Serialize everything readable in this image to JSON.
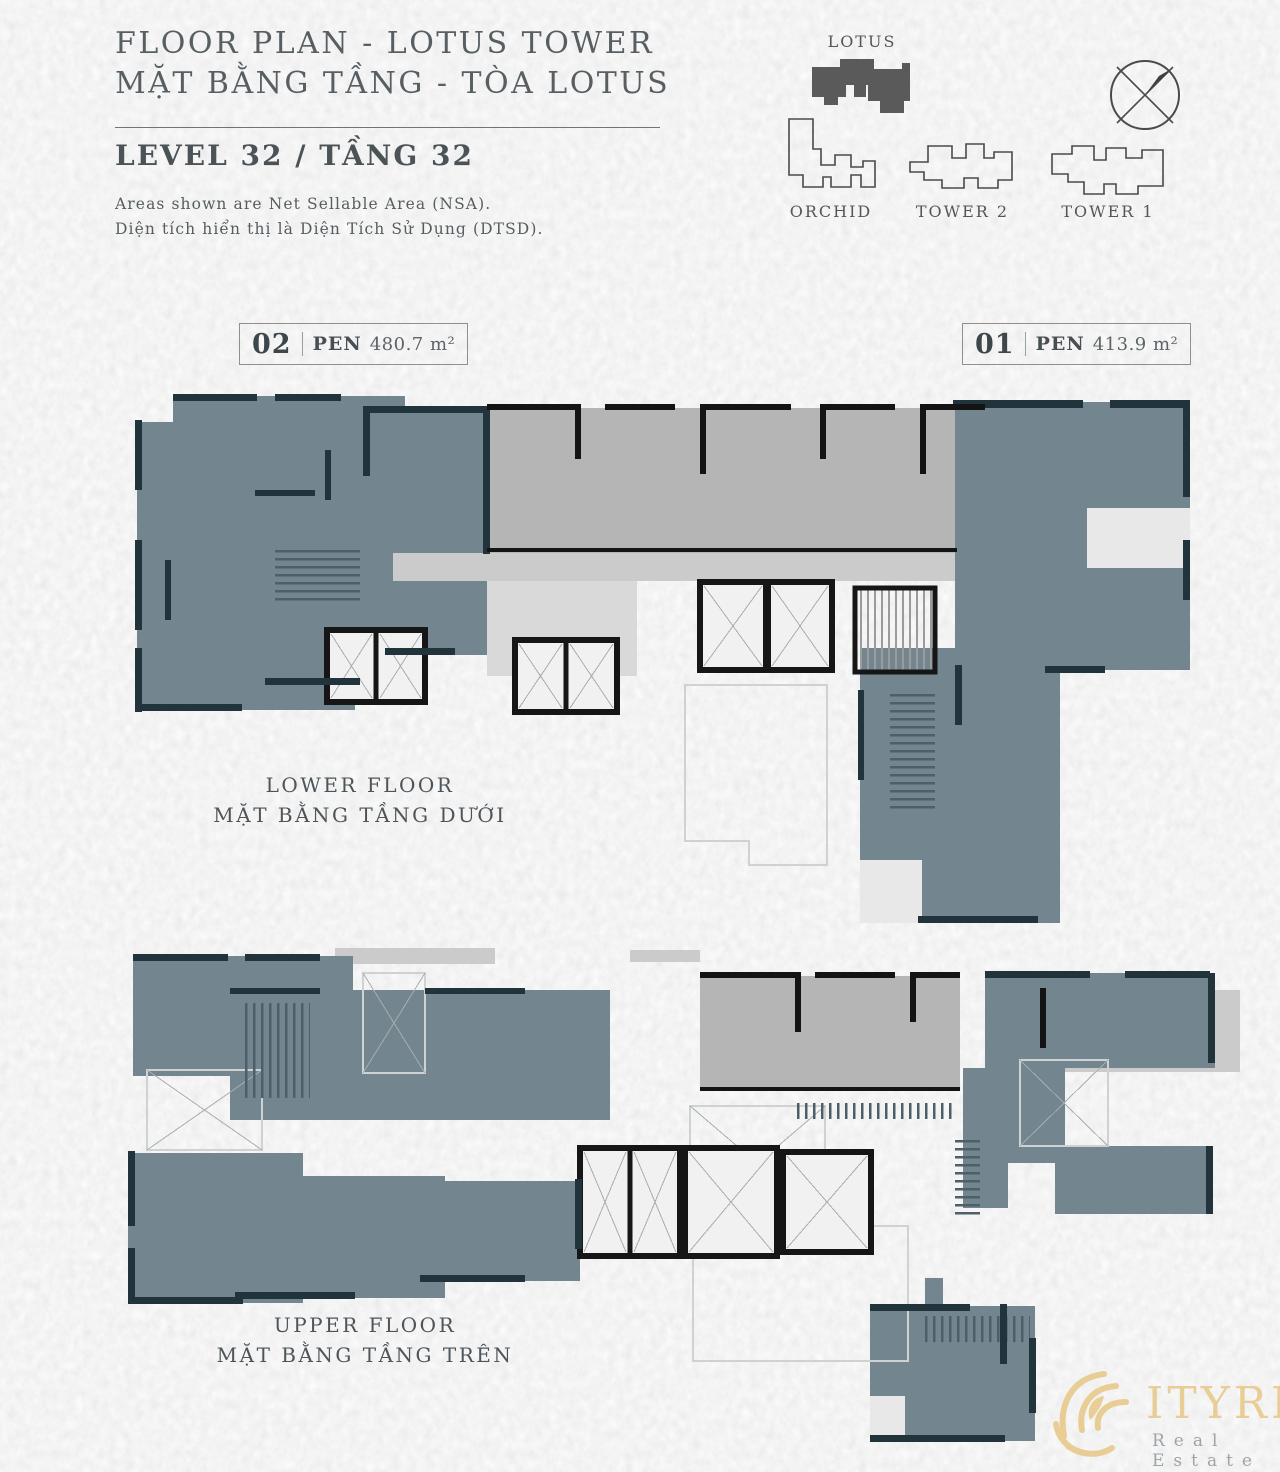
{
  "header": {
    "title_line1": "FLOOR PLAN - LOTUS TOWER",
    "title_line2": "MẶT BẰNG TẦNG - TÒA LOTUS",
    "level_heading": "LEVEL 32 / TẦNG 32",
    "note_en": "Areas shown are Net Sellable Area (NSA).",
    "note_vi": "Diện tích hiển thị là Diện Tích Sử Dụng (DTSD)."
  },
  "building_key": {
    "towers": [
      {
        "name": "LOTUS",
        "highlighted": true
      },
      {
        "name": "ORCHID",
        "highlighted": false
      },
      {
        "name": "TOWER 2",
        "highlighted": false
      },
      {
        "name": "TOWER 1",
        "highlighted": false
      }
    ],
    "compass_icon": "compass-north-indicator"
  },
  "unit_tags": [
    {
      "number": "02",
      "type": "PEN",
      "area": "480.7 m²"
    },
    {
      "number": "01",
      "type": "PEN",
      "area": "413.9 m²"
    }
  ],
  "floor_plans": [
    {
      "id": "lower-floor",
      "label_en": "LOWER FLOOR",
      "label_vi": "MẶT BẰNG TẦNG DƯỚI"
    },
    {
      "id": "upper-floor",
      "label_en": "UPPER FLOOR",
      "label_vi": "MẶT BẰNG TẦNG TRÊN"
    }
  ],
  "watermark": {
    "brand_text": "ITYRISE",
    "brand_name": "CityRise",
    "subtitle": "Real Estate"
  },
  "colors": {
    "paper": "#e8e8e8",
    "ink": "#50585c",
    "unit_fill": "#73858e",
    "unit_wall": "#21343c",
    "common_fill": "#b5b5b5",
    "common_light": "#cbcbcb",
    "core_wall": "#161616",
    "key_dark": "#5a5a5a",
    "gold": "#e8ca8e",
    "subtle": "#99a0a5"
  }
}
